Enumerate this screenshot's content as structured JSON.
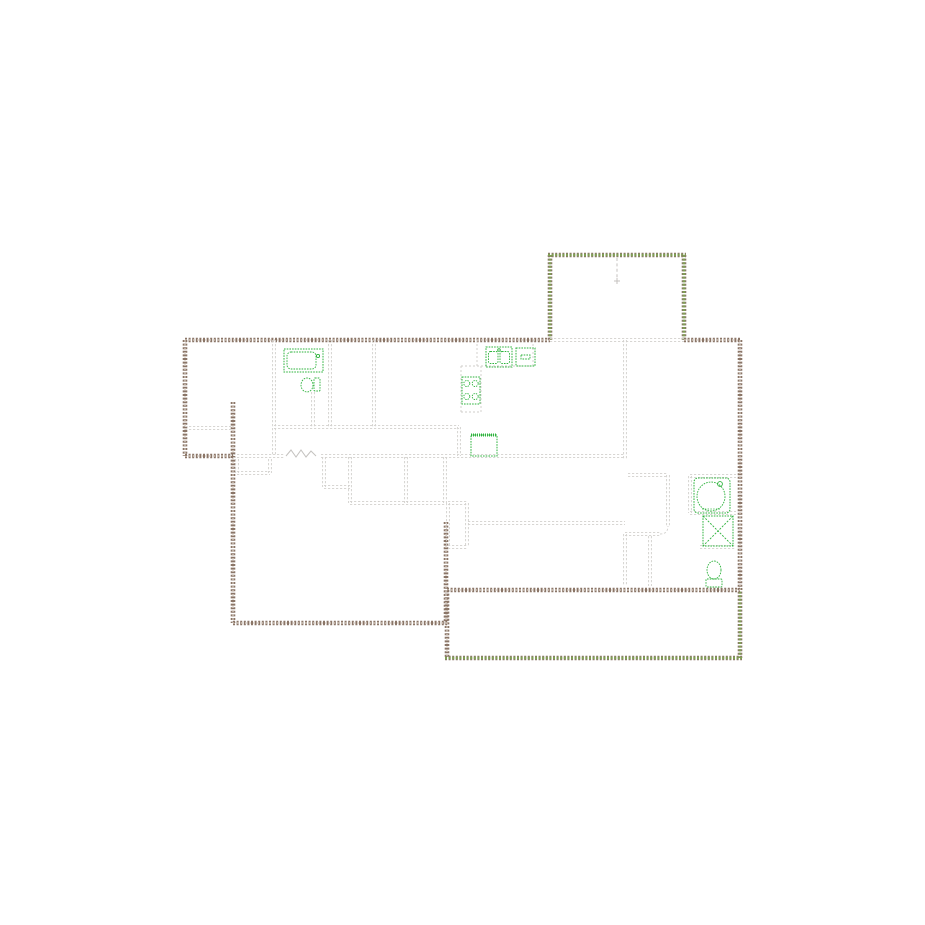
{
  "app": {
    "title": "Residential floor plan drawing",
    "view": "plan-view"
  },
  "canvas": {
    "width": 925,
    "height": 925,
    "background": "#ffffff"
  },
  "colors": {
    "exterior_wall": "#8b7668",
    "exterior_wall_core": "#d9cfc5",
    "garage_wall_green": "#7fa054",
    "interior_wall": "#d2d0cd",
    "counter_line": "#cfcdc9",
    "fixture_green": "#2db33c",
    "marker_gray": "#c4c2bf"
  },
  "walls": {
    "exterior": [
      [
        185,
        340,
        550,
        340
      ],
      [
        684,
        340,
        740,
        340
      ],
      [
        740,
        340,
        740,
        590
      ],
      [
        447,
        590,
        740,
        590
      ],
      [
        447,
        590,
        447,
        658
      ],
      [
        446,
        522,
        446,
        623
      ],
      [
        233,
        623,
        447,
        623
      ],
      [
        233,
        402,
        233,
        623
      ],
      [
        185,
        456,
        233,
        456
      ],
      [
        185,
        340,
        185,
        456
      ]
    ],
    "garage_green": [
      [
        550,
        255,
        550,
        341
      ],
      [
        548,
        255,
        686,
        255
      ],
      [
        684,
        255,
        684,
        341
      ],
      [
        740,
        588,
        740,
        658
      ],
      [
        445,
        658,
        742,
        658
      ]
    ],
    "interior": [
      [
        550,
        340,
        684,
        340
      ],
      [
        185,
        428,
        233,
        428
      ],
      [
        274,
        340,
        274,
        456
      ],
      [
        330,
        340,
        330,
        427
      ],
      [
        374,
        340,
        374,
        427
      ],
      [
        274,
        427,
        459,
        427
      ],
      [
        459,
        427,
        459,
        456
      ],
      [
        233,
        456,
        625,
        456
      ],
      [
        313,
        392,
        313,
        427
      ],
      [
        237,
        459,
        237,
        473
      ],
      [
        237,
        473,
        270,
        473
      ],
      [
        270,
        459,
        270,
        473
      ],
      [
        324,
        457,
        324,
        487
      ],
      [
        324,
        487,
        350,
        487
      ],
      [
        350,
        457,
        350,
        503
      ],
      [
        406,
        457,
        406,
        503
      ],
      [
        445,
        457,
        445,
        503
      ],
      [
        350,
        503,
        445,
        503
      ],
      [
        448,
        503,
        467,
        503
      ],
      [
        448,
        503,
        448,
        547
      ],
      [
        467,
        503,
        467,
        547
      ],
      [
        448,
        547,
        467,
        547
      ],
      [
        468,
        523,
        625,
        523
      ],
      [
        625,
        340,
        625,
        460
      ],
      [
        628,
        475,
        668,
        475
      ],
      [
        668,
        475,
        668,
        526
      ],
      [
        625,
        534,
        660,
        534
      ],
      [
        625,
        534,
        625,
        586
      ],
      [
        650,
        536,
        650,
        586
      ],
      [
        690,
        476,
        736,
        476
      ],
      [
        690,
        476,
        690,
        513
      ],
      [
        690,
        513,
        736,
        513
      ],
      [
        700,
        547,
        736,
        547
      ]
    ],
    "arcs": [
      "M660,534 Q668,534 668,526"
    ]
  },
  "counters": [
    [
      477,
      340,
      477,
      366
    ],
    [
      477,
      366,
      533,
      366
    ],
    [
      533,
      340,
      533,
      366
    ],
    [
      461,
      366,
      481,
      366
    ],
    [
      461,
      366,
      461,
      412
    ],
    [
      481,
      366,
      481,
      412
    ],
    [
      461,
      412,
      481,
      412
    ]
  ],
  "fixtures": [
    {
      "type": "bathtub",
      "name": "bathtub-fixture",
      "x": 284,
      "y": 349,
      "w": 39,
      "h": 23
    },
    {
      "type": "toilet-side",
      "name": "toilet-fixture-hall",
      "x": 300,
      "y": 376,
      "w": 21,
      "h": 17
    },
    {
      "type": "kitchen-sink",
      "name": "kitchen-sink-fixture",
      "x": 486,
      "y": 347,
      "w": 26,
      "h": 20
    },
    {
      "type": "appliance",
      "name": "appliance-fixture",
      "x": 516,
      "y": 348,
      "w": 19,
      "h": 18
    },
    {
      "type": "range",
      "name": "range-fixture",
      "x": 462,
      "y": 377,
      "w": 18,
      "h": 27
    },
    {
      "type": "island",
      "name": "island-fixture",
      "x": 471,
      "y": 435,
      "w": 26,
      "h": 21
    },
    {
      "type": "garden-tub",
      "name": "garden-tub-fixture",
      "x": 694,
      "y": 478,
      "w": 36,
      "h": 35
    },
    {
      "type": "shower",
      "name": "shower-fixture",
      "x": 703,
      "y": 516,
      "w": 30,
      "h": 30
    },
    {
      "type": "toilet-up",
      "name": "toilet-fixture-master",
      "x": 703,
      "y": 560,
      "w": 22,
      "h": 28
    }
  ],
  "door_marker": {
    "line": [
      617,
      258,
      617,
      279
    ],
    "cross": [
      617,
      281
    ]
  },
  "break_symbol": {
    "cover": [
      285,
      451,
      35,
      10
    ],
    "points": "286,456 291,450 296,457 301,450 306,457 311,451 316,456"
  }
}
